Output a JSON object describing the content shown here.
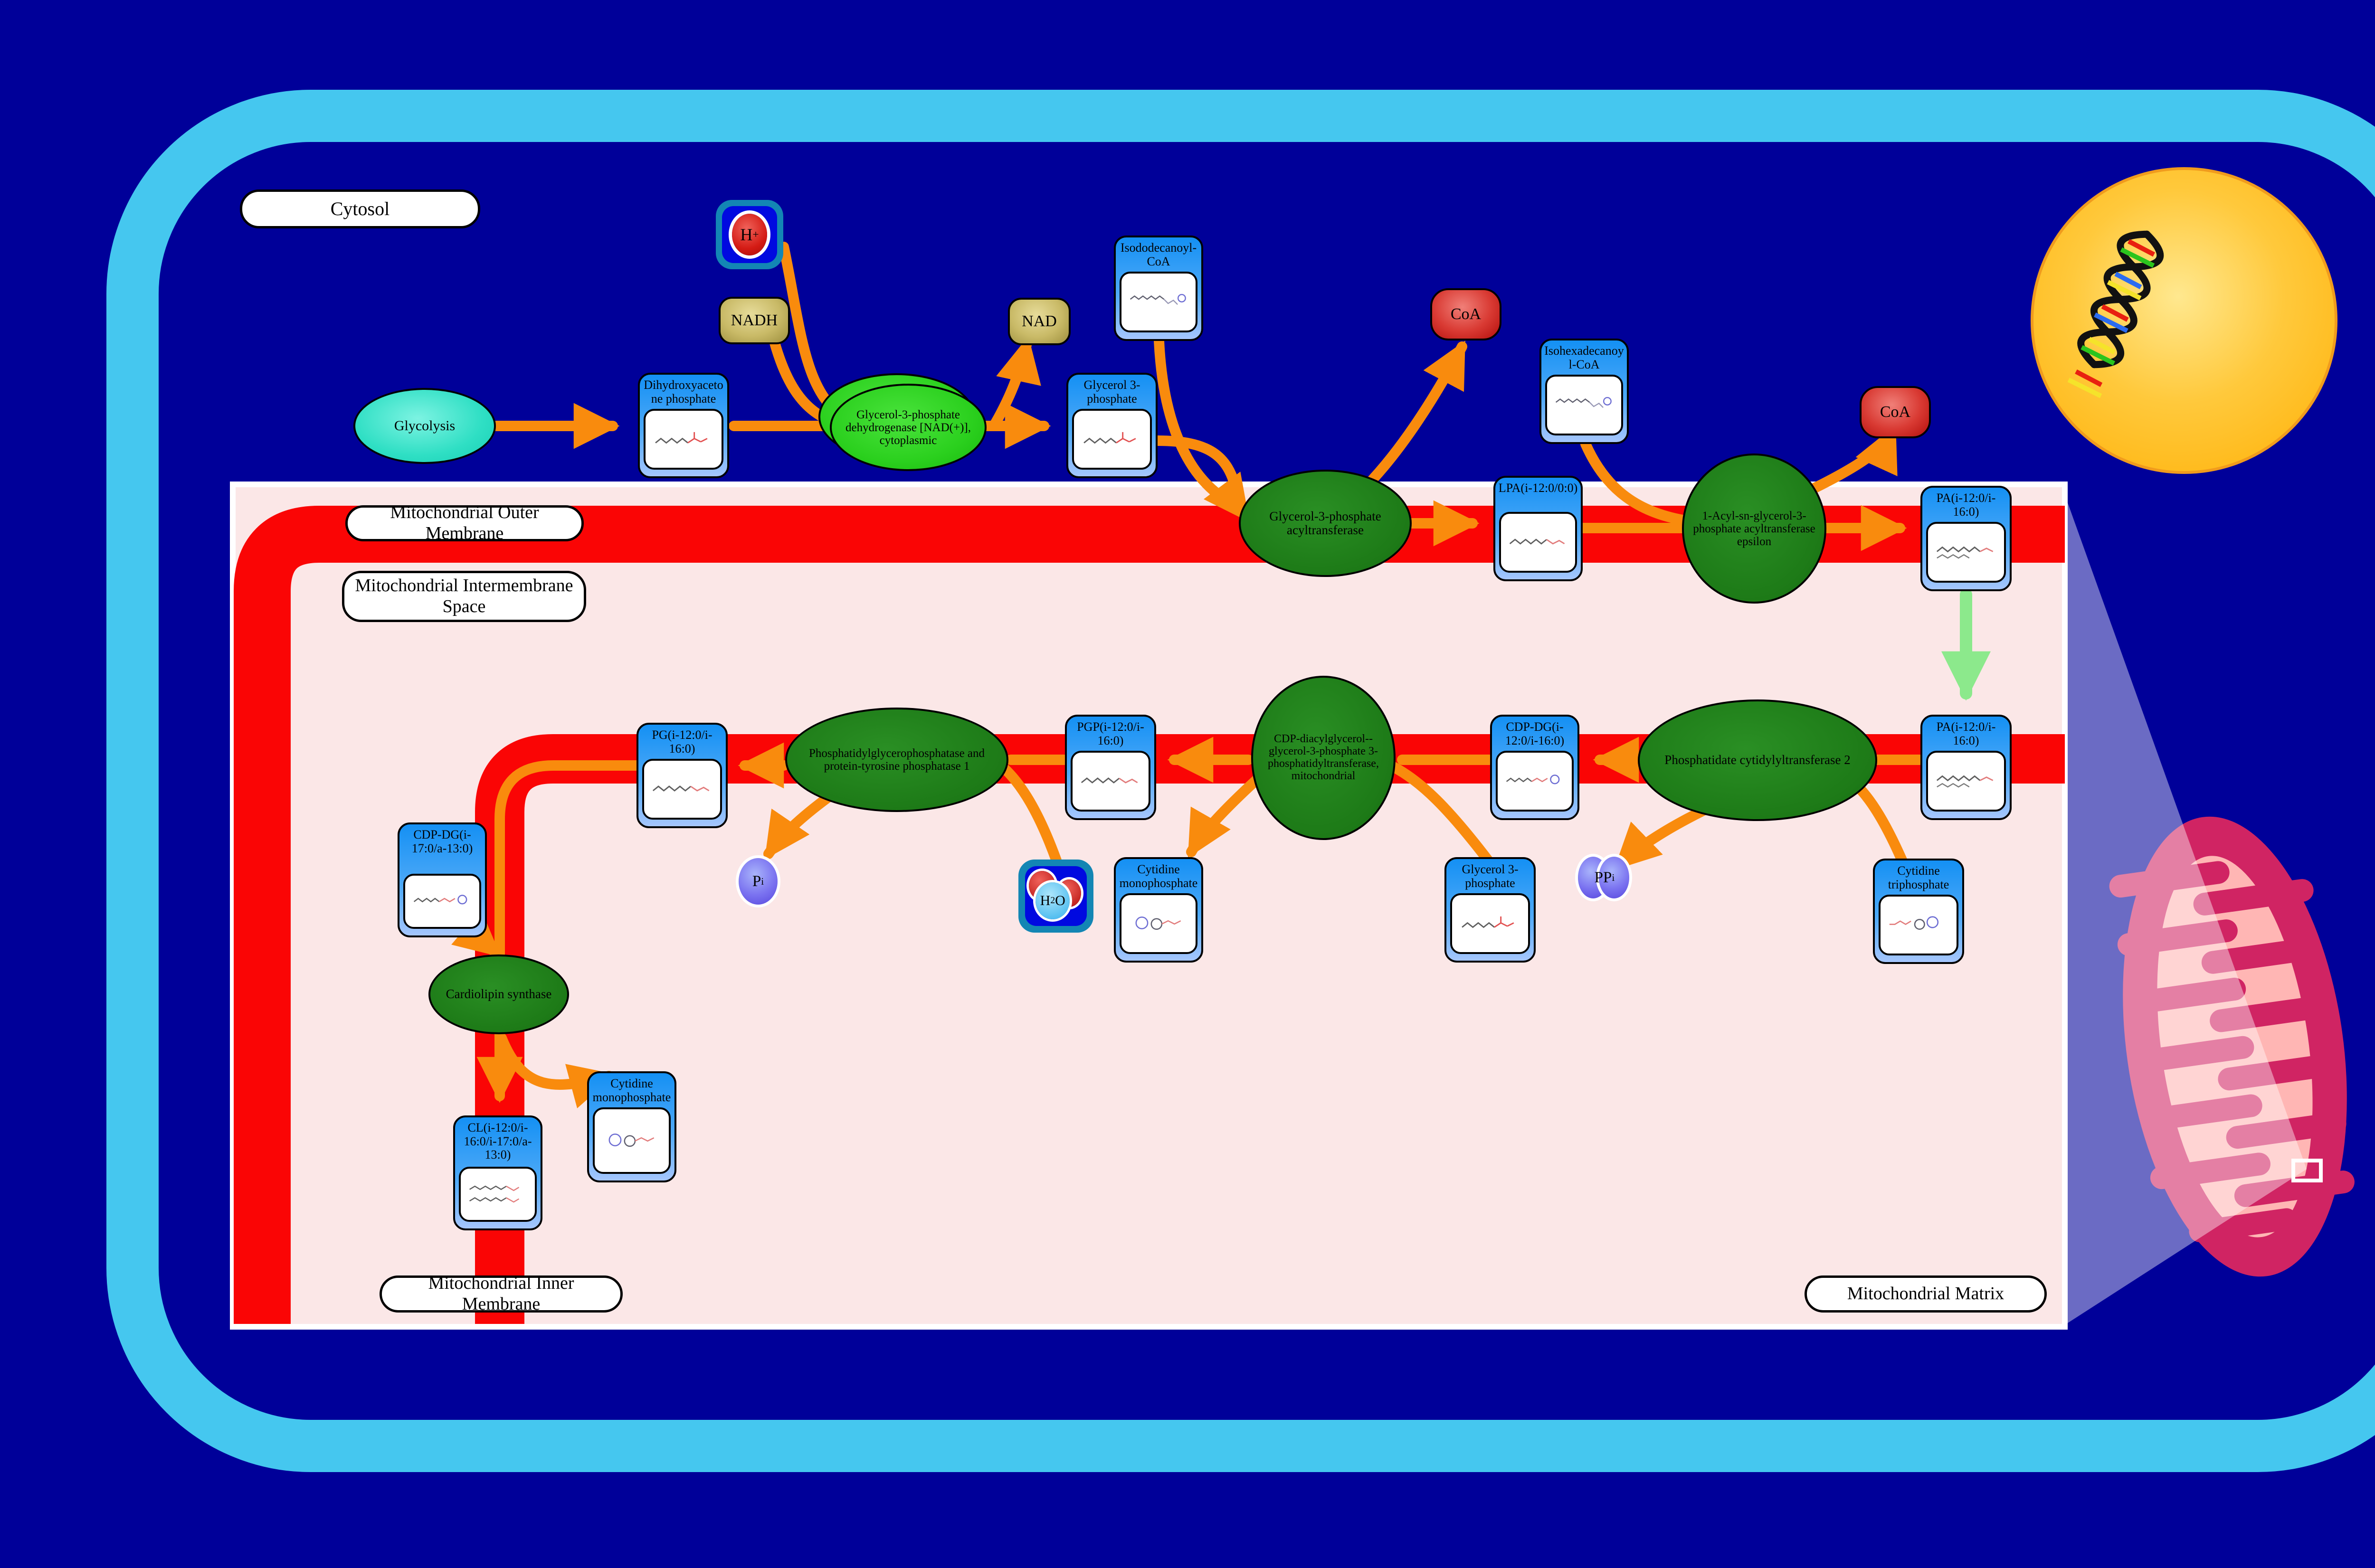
{
  "compartments": {
    "cytosol": "Cytosol",
    "outer_membrane": "Mitochondrial Outer Membrane",
    "intermembrane_space": "Mitochondrial Intermembrane Space",
    "inner_membrane": "Mitochondrial Inner Membrane",
    "matrix": "Mitochondrial Matrix"
  },
  "pathway_nodes": {
    "glycolysis": "Glycolysis"
  },
  "metabolites": [
    {
      "label": "Dihydroxyacetone phosphate"
    },
    {
      "label": "Glycerol 3-phosphate"
    },
    {
      "label": "Isododecanoyl-CoA"
    },
    {
      "label": "LPA(i-12:0/0:0)"
    },
    {
      "label": "Isohexadecanoyl-CoA"
    },
    {
      "label": "PA(i-12:0/i-16:0)"
    },
    {
      "label": "PA(i-12:0/i-16:0)"
    },
    {
      "label": "CDP-DG(i-12:0/i-16:0)"
    },
    {
      "label": "PGP(i-12:0/i-16:0)"
    },
    {
      "label": "PG(i-12:0/i-16:0)"
    },
    {
      "label": "Cytidine triphosphate"
    },
    {
      "label": "Glycerol 3-phosphate"
    },
    {
      "label": "Cytidine monophosphate"
    },
    {
      "label": "CDP-DG(i-17:0/a-13:0)"
    },
    {
      "label": "Cytidine monophosphate"
    },
    {
      "label": "CL(i-12:0/i-16:0/i-17:0/a-13:0)"
    }
  ],
  "enzymes": [
    {
      "label": "Glycerol-3-phosphate dehydrogenase [NAD(+)], cytoplasmic"
    },
    {
      "label": "Glycerol-3-phosphate acyltransferase"
    },
    {
      "label": "1-Acyl-sn-glycerol-3-phosphate acyltransferase epsilon"
    },
    {
      "label": "Phosphatidate cytidylyltransferase 2"
    },
    {
      "label": "CDP-diacylglycerol--glycerol-3-phosphate 3-phosphatidyltransferase, mitochondrial"
    },
    {
      "label": "Phosphatidylglycerophosphatase and protein-tyrosine phosphatase 1"
    },
    {
      "label": "Cardiolipin synthase"
    }
  ],
  "cofactors": {
    "nadh": "NADH",
    "nad": "NAD",
    "coa_1": "CoA",
    "coa_2": "CoA",
    "proton_symbol": "H",
    "proton_charge": "+",
    "water_h": "H",
    "water_2": "2",
    "water_o": "O",
    "pi_symbol": "P",
    "pi_sub": "i",
    "ppi_symbol": "PP",
    "ppi_sub": "i"
  },
  "colors": {
    "background_navy": "#000099",
    "cell_border_blue": "#45c7ef",
    "membrane_red": "#fa0505",
    "compartment_pink": "#fbe7e7",
    "arrow_orange": "#f98b0d",
    "arrow_green": "#8ce98c",
    "enzyme_green": "#1d7a17",
    "cytosolic_enzyme_green": "#2bd01e",
    "pathway_teal": "#2fdfc4",
    "metabolite_blue": "#1490f4",
    "nucleus_yellow": "#ffc93c",
    "mitochondrion_crimson": "#d02463"
  }
}
